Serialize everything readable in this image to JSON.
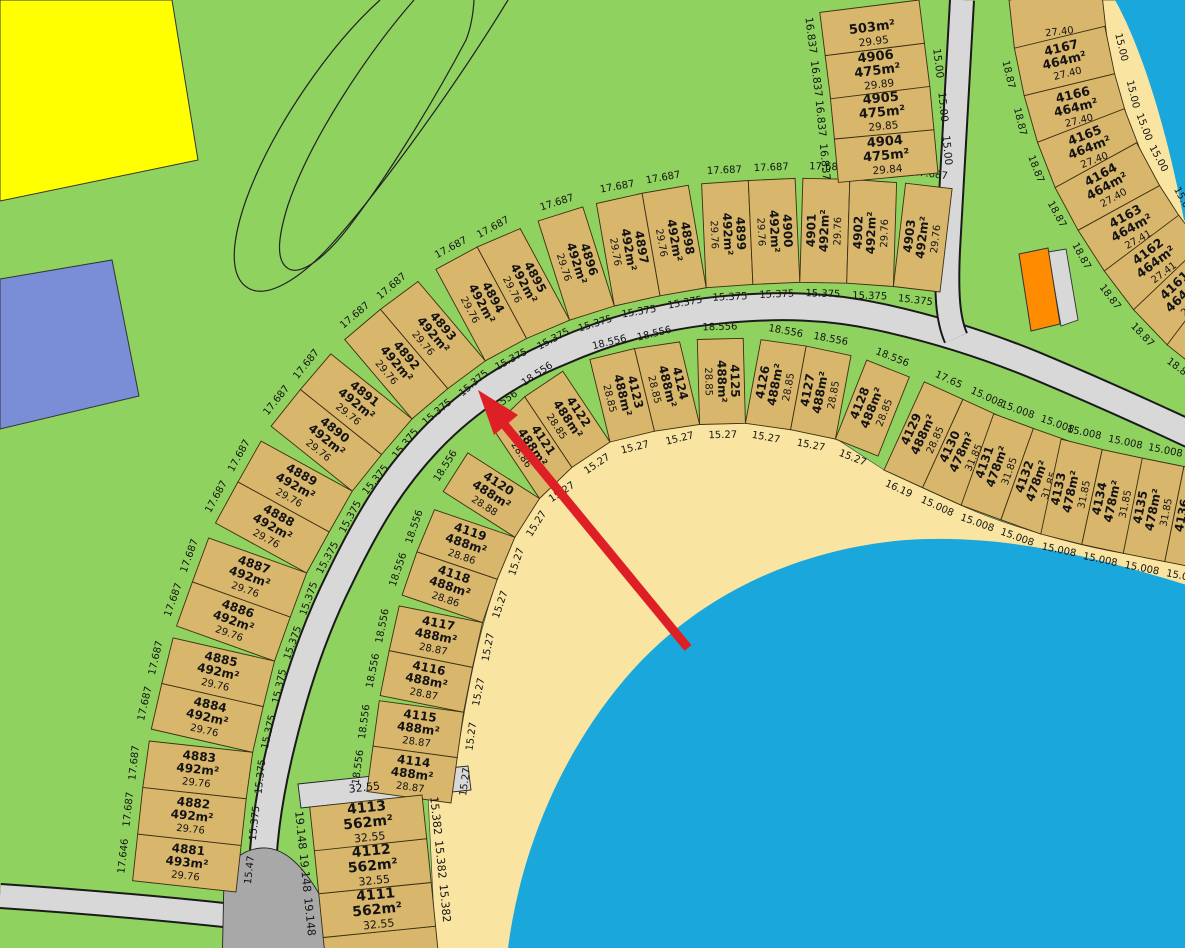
{
  "colors": {
    "grass": "#8FD25F",
    "water": "#1AA7DB",
    "sand": "#F9E4A2",
    "road": "#D8D8D8",
    "road_casing": "#1a1a1a",
    "road_dark": "#A8A8A8",
    "lot_fill": "#D8B66C",
    "lot_line": "#3b2f12",
    "yellow_parcel": "#FFFF00",
    "blue_parcel": "#7A8ED8",
    "orange_parcel": "#FF8C00",
    "arrow": "#DF1F26",
    "outline": "#222222"
  },
  "annotation": {
    "type": "arrow",
    "color": "#DF1F26"
  },
  "rows": [
    {
      "id": "row-a",
      "lots": [
        {
          "number": "4881",
          "area": "493m²",
          "dim": "29.76",
          "outer": "17.646",
          "inner": "15.47"
        },
        {
          "number": "4882",
          "area": "492m²",
          "dim": "29.76",
          "outer": "17.687",
          "inner": "15.375"
        },
        {
          "number": "4883",
          "area": "492m²",
          "dim": "29.76",
          "outer": "17.687",
          "inner": "15.375"
        },
        {
          "number": "4884",
          "area": "492m²",
          "dim": "29.76",
          "outer": "17.687",
          "inner": "15.375"
        },
        {
          "number": "4885",
          "area": "492m²",
          "dim": "29.76",
          "outer": "17.687",
          "inner": "15.375"
        },
        {
          "number": "4886",
          "area": "492m²",
          "dim": "29.76",
          "outer": "17.687",
          "inner": "15.375"
        },
        {
          "number": "4887",
          "area": "492m²",
          "dim": "29.76",
          "outer": "17.687",
          "inner": "15.375"
        },
        {
          "number": "4888",
          "area": "492m²",
          "dim": "29.76",
          "outer": "17.687",
          "inner": "15.375"
        },
        {
          "number": "4889",
          "area": "492m²",
          "dim": "29.76",
          "outer": "17.687",
          "inner": "15.375"
        },
        {
          "number": "4890",
          "area": "492m²",
          "dim": "29.76",
          "outer": "17.687",
          "inner": "15.375"
        },
        {
          "number": "4891",
          "area": "492m²",
          "dim": "29.76",
          "outer": "17.687",
          "inner": "15.375"
        },
        {
          "number": "4892",
          "area": "492m²",
          "dim": "29.76",
          "outer": "17.687",
          "inner": "15.375"
        },
        {
          "number": "4893",
          "area": "492m²",
          "dim": "29.76",
          "outer": "17.687",
          "inner": "15.375"
        },
        {
          "number": "4894",
          "area": "492m²",
          "dim": "29.76",
          "outer": "17.687",
          "inner": "15.375"
        },
        {
          "number": "4895",
          "area": "492m²",
          "dim": "29.76",
          "outer": "17.687",
          "inner": "15.375"
        },
        {
          "number": "4896",
          "area": "492m²",
          "dim": "29.76",
          "outer": "17.687",
          "inner": "15.375"
        },
        {
          "number": "4897",
          "area": "492m²",
          "dim": "29.76",
          "outer": "17.687",
          "inner": "15.375"
        },
        {
          "number": "4898",
          "area": "492m²",
          "dim": "29.76",
          "outer": "17.687",
          "inner": "15.375"
        },
        {
          "number": "4899",
          "area": "492m²",
          "dim": "29.76",
          "outer": "17.687",
          "inner": "15.375"
        },
        {
          "number": "4900",
          "area": "492m²",
          "dim": "29.76",
          "outer": "17.687",
          "inner": "15.375"
        },
        {
          "number": "4901",
          "area": "492m²",
          "dim": "29.76",
          "outer": "17.687",
          "inner": "15.375"
        },
        {
          "number": "4902",
          "area": "492m²",
          "dim": "29.76",
          "outer": "17.687",
          "inner": "15.375"
        },
        {
          "number": "4903",
          "area": "492m²",
          "dim": "29.76",
          "outer": "17.687",
          "inner": "15.375"
        }
      ]
    },
    {
      "id": "row-b",
      "lots": [
        {
          "number": "4114",
          "area": "488m²",
          "dim": "28.87",
          "outer": "18.556",
          "inner": "15.27"
        },
        {
          "number": "4115",
          "area": "488m²",
          "dim": "28.87",
          "outer": "18.556",
          "inner": "15.27"
        },
        {
          "number": "4116",
          "area": "488m²",
          "dim": "28.87",
          "outer": "18.556",
          "inner": "15.27"
        },
        {
          "number": "4117",
          "area": "488m²",
          "dim": "28.87",
          "outer": "18.556",
          "inner": "15.27"
        },
        {
          "number": "4118",
          "area": "488m²",
          "dim": "28.86",
          "outer": "18.556",
          "inner": "15.27"
        },
        {
          "number": "4119",
          "area": "488m²",
          "dim": "28.86",
          "outer": "18.556",
          "inner": "15.27"
        },
        {
          "number": "4120",
          "area": "488m²",
          "dim": "28.88",
          "outer": "18.556",
          "inner": "15.27"
        },
        {
          "number": "4121",
          "area": "488m²",
          "dim": "28.86",
          "outer": "18.556",
          "inner": "15.27"
        },
        {
          "number": "4122",
          "area": "488m²",
          "dim": "28.85",
          "outer": "18.556",
          "inner": "15.27"
        },
        {
          "number": "4123",
          "area": "488m²",
          "dim": "28.85",
          "outer": "18.556",
          "inner": "15.27"
        },
        {
          "number": "4124",
          "area": "488m²",
          "dim": "28.85",
          "outer": "18.556",
          "inner": "15.27"
        },
        {
          "number": "4125",
          "area": "488m²",
          "dim": "28.85",
          "outer": "18.556",
          "inner": "15.27"
        },
        {
          "number": "4126",
          "area": "488m²",
          "dim": "28.85",
          "outer": "18.556",
          "inner": "15.27"
        },
        {
          "number": "4127",
          "area": "488m²",
          "dim": "28.85",
          "outer": "18.556",
          "inner": "15.27"
        },
        {
          "number": "4128",
          "area": "488m²",
          "dim": "28.85",
          "outer": "18.556",
          "inner": "15.27"
        }
      ]
    },
    {
      "id": "row-c",
      "lots": [
        {
          "number": "4129",
          "area": "488m²",
          "dim": "28.85",
          "outer": "17.65",
          "inner": "16.19"
        },
        {
          "number": "4130",
          "area": "478m²",
          "dim": "31.85",
          "outer": "15.008",
          "inner": "15.008"
        },
        {
          "number": "4131",
          "area": "478m²",
          "dim": "31.85",
          "outer": "15.008",
          "inner": "15.008"
        },
        {
          "number": "4132",
          "area": "478m²",
          "dim": "31.85",
          "outer": "15.008",
          "inner": "15.008"
        },
        {
          "number": "4133",
          "area": "478m²",
          "dim": "31.85",
          "outer": "15.008",
          "inner": "15.008"
        },
        {
          "number": "4134",
          "area": "478m²",
          "dim": "31.85",
          "outer": "15.008",
          "inner": "15.008"
        },
        {
          "number": "4135",
          "area": "478m²",
          "dim": "31.85",
          "outer": "15.008",
          "inner": "15.008"
        },
        {
          "number": "4136",
          "area": "478m²",
          "dim": "31.85",
          "outer": "15.008",
          "inner": "15.008"
        },
        {
          "number": "",
          "area": "",
          "dim": "",
          "outer": "",
          "inner": ""
        }
      ]
    },
    {
      "id": "col-d",
      "cap": "32.55",
      "lots": [
        {
          "number": "",
          "area": "",
          "dim": "",
          "outer": "",
          "inner": ""
        },
        {
          "number": "4111",
          "area": "562m²",
          "dim": "32.55",
          "outer": "19.148",
          "inner": "15.382"
        },
        {
          "number": "4112",
          "area": "562m²",
          "dim": "32.55",
          "outer": "19.148",
          "inner": "15.382"
        },
        {
          "number": "4113",
          "area": "562m²",
          "dim": "32.55",
          "outer": "19.148",
          "inner": "15.382"
        }
      ]
    },
    {
      "id": "col-e",
      "lots": [
        {
          "number": "4904",
          "area": "475m²",
          "dim": "29.84",
          "outer": "16.837",
          "inner": "15.00"
        },
        {
          "number": "4905",
          "area": "475m²",
          "dim": "29.85",
          "outer": "16.837",
          "inner": "15.00"
        },
        {
          "number": "4906",
          "area": "475m²",
          "dim": "29.89",
          "outer": "16.837",
          "inner": "15.00"
        },
        {
          "number": "",
          "area": "503m²",
          "dim": "29.95",
          "outer": "16.837",
          "inner": ""
        }
      ]
    },
    {
      "id": "col-f",
      "lots": [
        {
          "number": "",
          "area": "",
          "dim": "27.40",
          "outer": "",
          "inner": ""
        },
        {
          "number": "4167",
          "area": "464m²",
          "dim": "27.40",
          "outer": "15.00",
          "inner": "18.87"
        },
        {
          "number": "4166",
          "area": "464m²",
          "dim": "27.40",
          "outer": "15.00",
          "inner": "18.87"
        },
        {
          "number": "4165",
          "area": "464m²",
          "dim": "27.40",
          "outer": "15.00",
          "inner": "18.87"
        },
        {
          "number": "4164",
          "area": "464m²",
          "dim": "27.40",
          "outer": "15.00",
          "inner": "18.87"
        },
        {
          "number": "4163",
          "area": "464m²",
          "dim": "27.41",
          "outer": "15.00",
          "inner": "18.87"
        },
        {
          "number": "4162",
          "area": "464m²",
          "dim": "27.41",
          "outer": "15.00",
          "inner": "18.87"
        },
        {
          "number": "4161",
          "area": "464m²",
          "dim": "27.41",
          "outer": "15.00",
          "inner": "18.87"
        },
        {
          "number": "4160",
          "area": "464m²",
          "dim": "27.41",
          "outer": "15.00",
          "inner": "18.87"
        }
      ]
    }
  ]
}
